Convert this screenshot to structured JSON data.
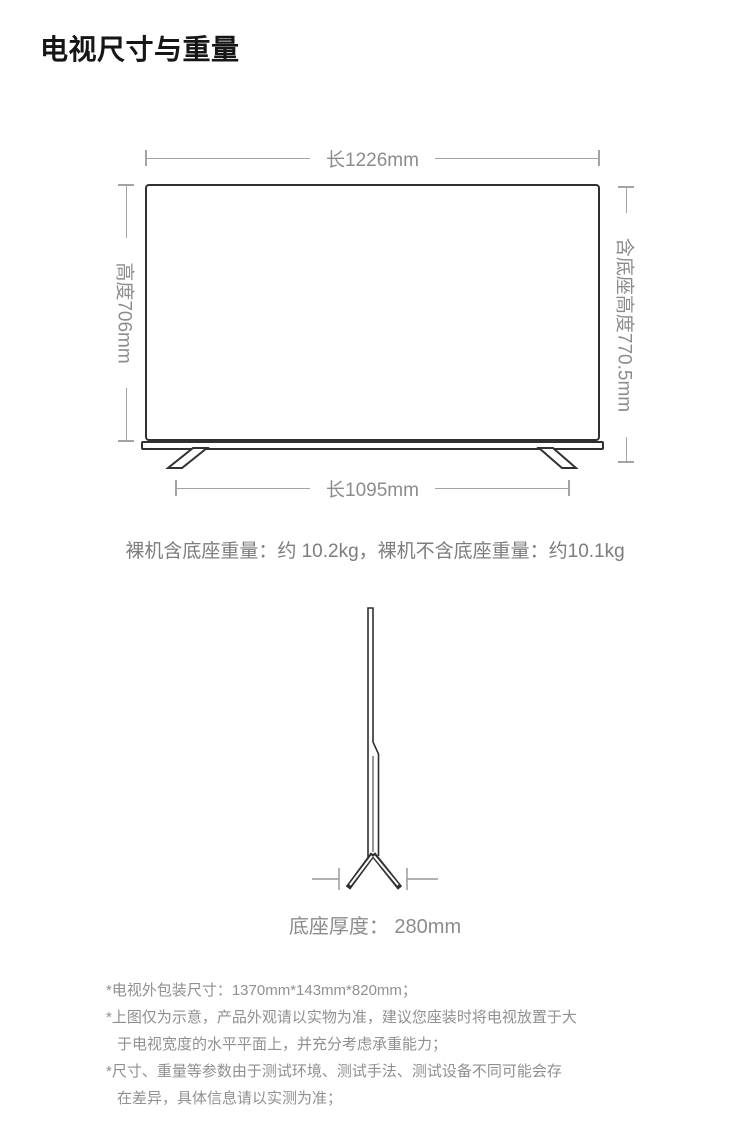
{
  "page": {
    "title": "电视尺寸与重量"
  },
  "front_view": {
    "top_width": "长1226mm",
    "panel_height": "高度706mm",
    "height_with_stand": "含底座高度770.5mm",
    "stand_span": "长1095mm"
  },
  "weight_line": "裸机含底座重量：约 10.2kg，裸机不含底座重量：约10.1kg",
  "side_view": {
    "base_depth": "底座厚度： 280mm"
  },
  "footnotes": [
    "*电视外包装尺寸：1370mm*143mm*820mm；",
    "*上图仅为示意，产品外观请以实物为准，建议您座装时将电视放置于大\n于电视宽度的水平平面上，并充分考虑承重能力；",
    "*尺寸、重量等参数由于测试环境、测试手法、测试设备不同可能会存\n在差异，具体信息请以实测为准；"
  ],
  "colors": {
    "outline": "#303030",
    "dimension_line": "#a3a3a3",
    "dimension_text": "#8c8c8c",
    "body_text": "#909090"
  }
}
